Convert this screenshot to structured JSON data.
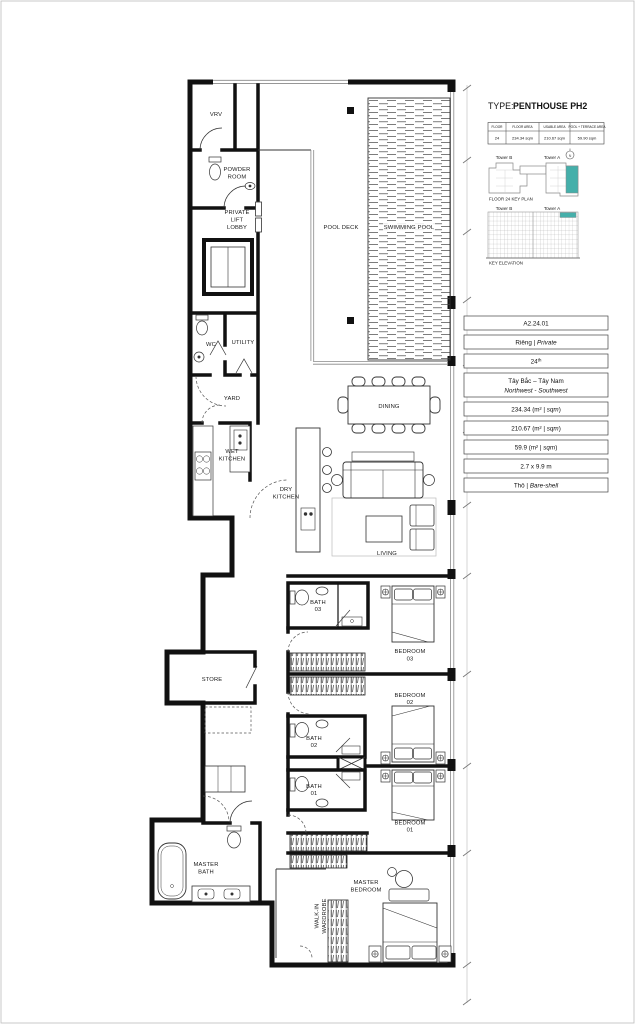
{
  "header": {
    "type_label": "TYPE:",
    "type_value": "PENTHOUSE PH2"
  },
  "spec_table": {
    "headers": [
      "FLOOR",
      "FLOOR AREA",
      "USABLE AREA",
      "POOL + TERRACE AREA"
    ],
    "values": [
      "24",
      "234.34 sqm",
      "210.67 sqm",
      "59.90 sqm"
    ]
  },
  "key_plan": {
    "tower_b": "Tower B",
    "tower_a": "Tower A",
    "caption": "FLOOR 24 KEY PLAN",
    "north": "N",
    "highlight_color": "#45AFAA"
  },
  "key_elevation": {
    "tower_b": "Tower B",
    "tower_a": "Tower A",
    "caption": "KEY ELEVATION",
    "highlight_color": "#45AFAA"
  },
  "unit_info": {
    "rows": [
      {
        "pre": "A2.24.01",
        "sup": "",
        "it": "",
        "post": "",
        "line2": ""
      },
      {
        "pre": "Riêng | ",
        "sup": "",
        "it": "Private",
        "post": "",
        "line2": ""
      },
      {
        "pre": "24",
        "sup": "th",
        "it": "",
        "post": "",
        "line2": ""
      },
      {
        "pre": "Tây Bắc – Tây Nam",
        "sup": "",
        "it": "",
        "post": "",
        "line2": "Northwest - Southwest"
      },
      {
        "pre": "234.34 (m² | ",
        "sup": "",
        "it": "sqm",
        "post": ")",
        "line2": ""
      },
      {
        "pre": "210.67 (m² | ",
        "sup": "",
        "it": "sqm",
        "post": ")",
        "line2": ""
      },
      {
        "pre": "59.9 (m² | ",
        "sup": "",
        "it": "sqm",
        "post": ")",
        "line2": ""
      },
      {
        "pre": "2.7 x 9.9 m",
        "sup": "",
        "it": "",
        "post": "",
        "line2": ""
      },
      {
        "pre": "Thô | ",
        "sup": "",
        "it": "Bare-shell",
        "post": "",
        "line2": ""
      }
    ]
  },
  "rooms": {
    "vrv": "VRV",
    "powder_l1": "POWDER",
    "powder_l2": "ROOM",
    "lift_l1": "PRIVATE",
    "lift_l2": "LIFT",
    "lift_l3": "LOBBY",
    "wc": "WC",
    "utility": "UTILITY",
    "yard": "YARD",
    "wet_l1": "WET",
    "wet_l2": "KITCHEN",
    "dry_l1": "DRY",
    "dry_l2": "KITCHEN",
    "pool_deck": "POOL DECK",
    "pool": "SWIMMING POOL",
    "dining": "DINING",
    "living": "LIVING",
    "bath03_l1": "BATH",
    "bath03_l2": "03",
    "bath02_l1": "BATH",
    "bath02_l2": "02",
    "bath01_l1": "BATH",
    "bath01_l2": "01",
    "bed03_l1": "BEDROOM",
    "bed03_l2": "03",
    "bed02_l1": "BEDROOM",
    "bed02_l2": "02",
    "bed01_l1": "BEDROOM",
    "bed01_l2": "01",
    "store": "STORE",
    "master_bath_l1": "MASTER",
    "master_bath_l2": "BATH",
    "master_bed_l1": "MASTER",
    "master_bed_l2": "BEDROOM",
    "walkin_l1": "WALK-IN",
    "walkin_l2": "WARDROBE"
  },
  "colors": {
    "wall": "#111111",
    "accent_teal": "#45AFAA"
  }
}
